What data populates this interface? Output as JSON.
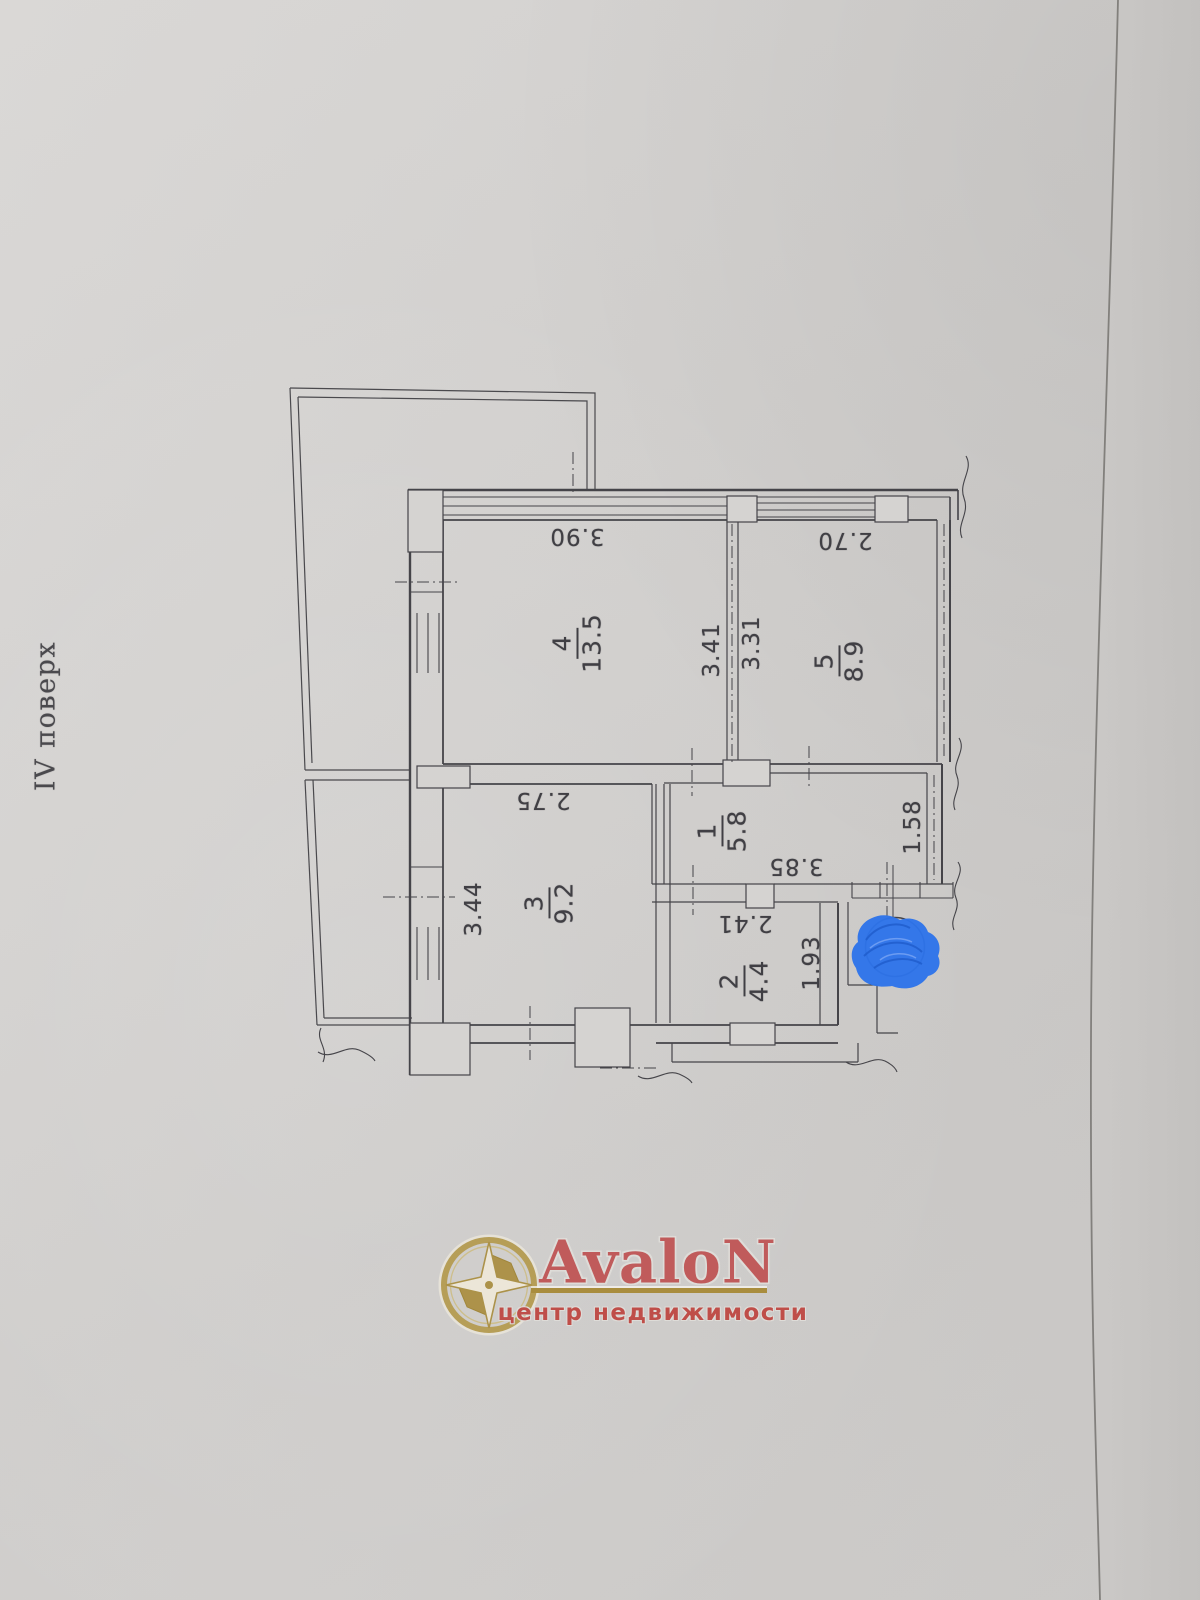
{
  "document": {
    "floor_label": "IV поверх"
  },
  "plan": {
    "rooms": [
      {
        "number": "4",
        "area": "13.5"
      },
      {
        "number": "5",
        "area": "8.9"
      },
      {
        "number": "1",
        "area": "5.8"
      },
      {
        "number": "3",
        "area": "9.2"
      },
      {
        "number": "2",
        "area": "4.4"
      }
    ],
    "dimensions": [
      "3.90",
      "2.70",
      "3.41",
      "3.31",
      "2.75",
      "3.44",
      "1.58",
      "3.85",
      "2.41",
      "1.93"
    ],
    "annotation": {
      "type": "blue-marker-scribble",
      "color": "#2e74ea"
    }
  },
  "logo": {
    "brand": "AvaloN",
    "tagline": "центр недвижимости",
    "brand_color": "#c05b5b",
    "accent_color": "#a98d3e"
  }
}
